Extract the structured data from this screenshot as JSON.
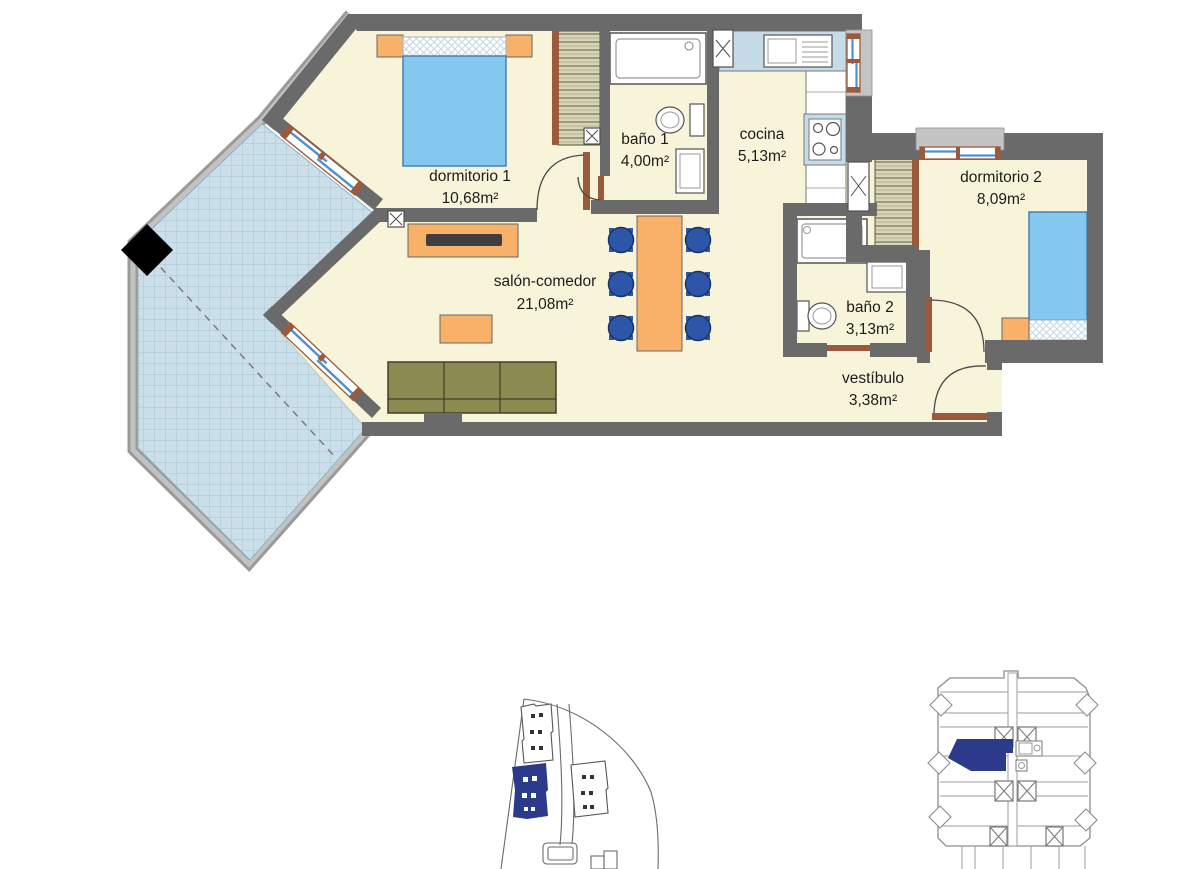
{
  "plan": {
    "rooms": [
      {
        "id": "dormitorio-1",
        "label": "dormitorio 1",
        "area": "10,68m²"
      },
      {
        "id": "bano-1",
        "label": "baño 1",
        "area": "4,00m²"
      },
      {
        "id": "cocina",
        "label": "cocina",
        "area": "5,13m²"
      },
      {
        "id": "dormitorio-2",
        "label": "dormitorio 2",
        "area": "8,09m²"
      },
      {
        "id": "bano-2",
        "label": "baño 2",
        "area": "3,13m²"
      },
      {
        "id": "salon-comedor",
        "label": "salón-comedor",
        "area": "21,08m²"
      },
      {
        "id": "vestibulo",
        "label": "vestíbulo",
        "area": "3,38m²"
      }
    ]
  },
  "colors": {
    "wall": "#6a6a6a",
    "parapet": "#b5b5b5",
    "floor": "#f8f4d9",
    "terrace_tile": "#cadfe9",
    "terrace_grid": "#a7c6d3",
    "bed": "#84c7ef",
    "furniture_orange": "#f9b169",
    "sofa_olive": "#8b8b51",
    "chair_blue": "#2d56a8",
    "counter_blue": "#c5dce8",
    "frame_brown": "#9c5a3c",
    "glass_blue": "#4d8fd6",
    "wardrobe_tan": "#d9d5b6",
    "keyplan_highlight": "#2c3a8c",
    "column_black": "#000000"
  }
}
